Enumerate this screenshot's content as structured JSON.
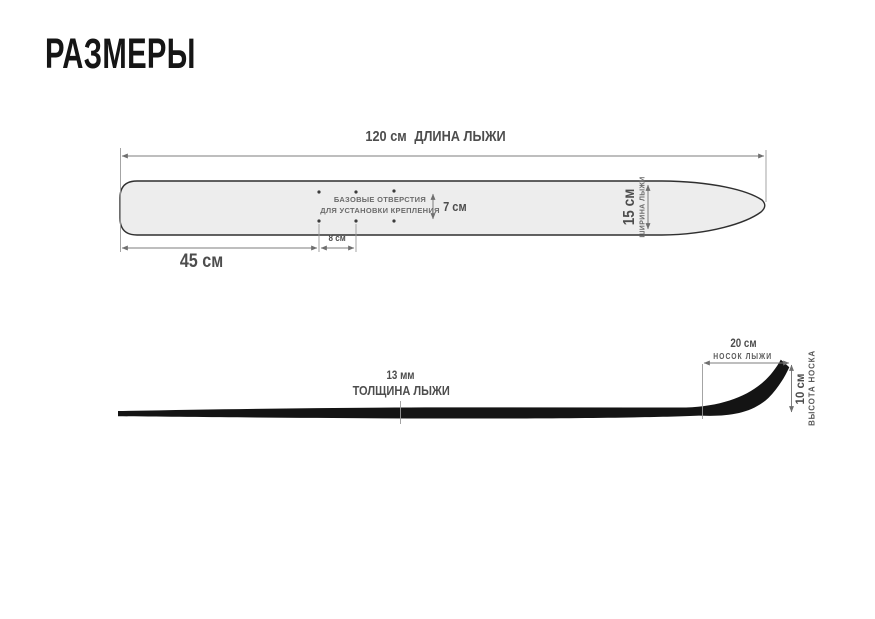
{
  "title": "РАЗМЕРЫ",
  "top_view": {
    "length": {
      "value": "120 см",
      "label": "ДЛИНА ЛЫЖИ"
    },
    "tail_to_holes": {
      "value": "45 см"
    },
    "hole_spacing": {
      "value": "8 см"
    },
    "hole_row_gap": {
      "value": "7 см"
    },
    "width": {
      "value": "15 см",
      "label": "ШИРИНА ЛЫЖИ"
    },
    "holes_note_line1": "БАЗОВЫЕ ОТВЕРСТИЯ",
    "holes_note_line2": "ДЛЯ УСТАНОВКИ КРЕПЛЕНИЯ",
    "mounting_holes": {
      "rows": 2,
      "cols": 3
    }
  },
  "side_view": {
    "thickness": {
      "value": "13 мм",
      "label": "ТОЛЩИНА ЛЫЖИ"
    },
    "tip_length": {
      "value": "20 см",
      "label": "НОСОК ЛЫЖИ"
    },
    "tip_height": {
      "value": "10 см",
      "label": "ВЫСОТА НОСКА"
    }
  },
  "colors": {
    "bg": "#ffffff",
    "ski_fill": "#ededed",
    "ski_stroke": "#2f2f2f",
    "profile": "#141414",
    "dim_line": "#7d7d7d",
    "ext_line": "#9a9a9a",
    "text_dark": "#151515",
    "text_mid": "#4d4d4d",
    "text_soft": "#6b6b6b"
  }
}
